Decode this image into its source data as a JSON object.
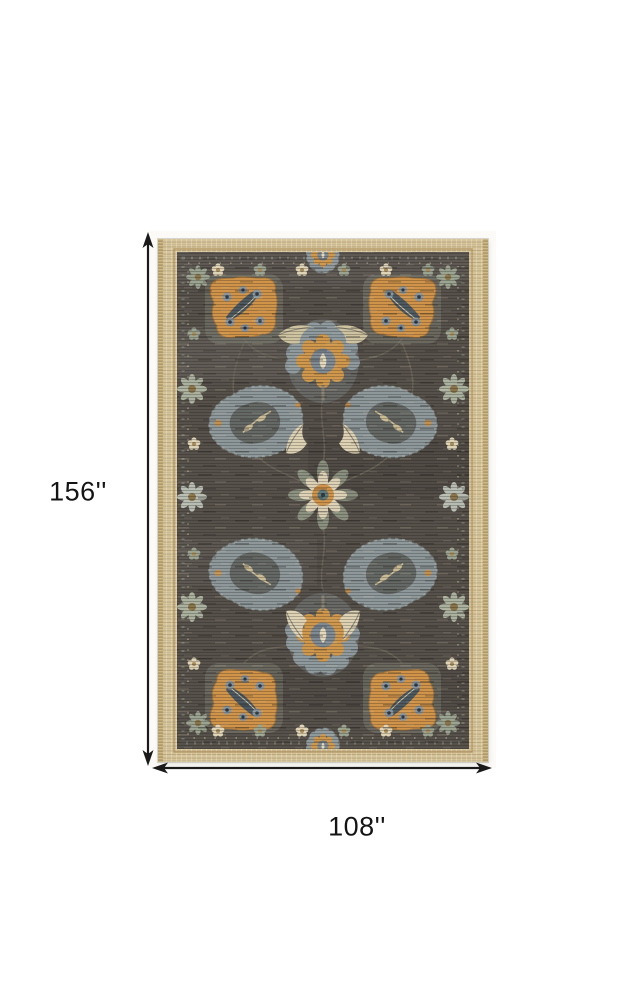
{
  "image": {
    "background_color": "#ffffff"
  },
  "dimensions": {
    "height_label": "156''",
    "width_label": "108''",
    "line_color": "#1a1a1a"
  },
  "rug": {
    "description": "Distressed oriental area rug: charcoal gray field with gold square medallions, slate-blue palmettes, sage and cream florals, inside a tan woven border",
    "colors": {
      "border_tan": "#d6c59b",
      "field_charcoal": "#57514b",
      "accent_gold": "#cf9349",
      "accent_slate": "#8e989b",
      "accent_sage": "#98a18d",
      "accent_cream": "#ddd2b4"
    }
  }
}
